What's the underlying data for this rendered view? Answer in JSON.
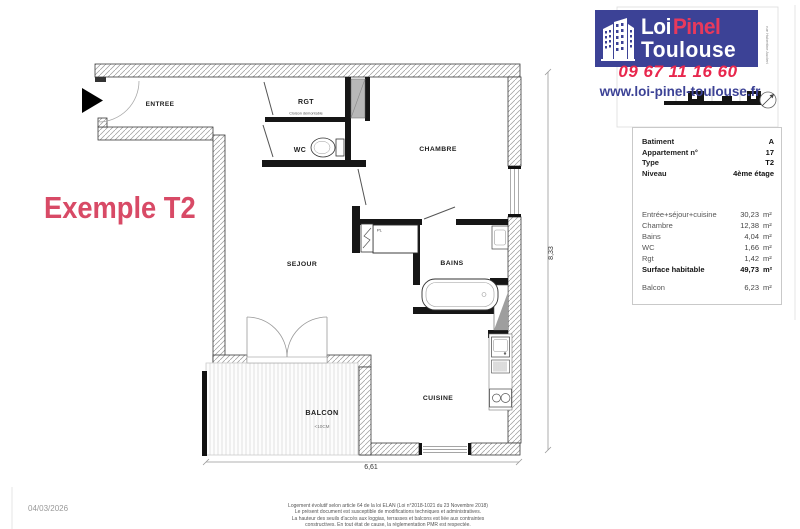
{
  "brand": {
    "logo_part1": "Loi",
    "logo_part2": "Pinel",
    "logo_line2": "Toulouse",
    "phone": "09 67 11 16 60",
    "website": "www.loi-pinel-toulouse.fr",
    "street_label": "rue Hubertine Auclert",
    "north_label": "N",
    "colors": {
      "brand_blue": "#3c4296",
      "brand_red": "#e8274d"
    }
  },
  "watermark": {
    "title": "Exemple T2",
    "color": "#d84a66"
  },
  "info_panel": {
    "fields": [
      {
        "label": "Batiment",
        "value": "A"
      },
      {
        "label": "Appartement n°",
        "value": "17"
      },
      {
        "label": "Type",
        "value": "T2"
      },
      {
        "label": "Niveau",
        "value": "4ème étage"
      }
    ],
    "areas": [
      {
        "label": "Entrée+séjour+cuisine",
        "value": "30,23",
        "unit": "m²"
      },
      {
        "label": "Chambre",
        "value": "12,38",
        "unit": "m²"
      },
      {
        "label": "Bains",
        "value": "4,04",
        "unit": "m²"
      },
      {
        "label": "WC",
        "value": "1,66",
        "unit": "m²"
      },
      {
        "label": "Rgt",
        "value": "1,42",
        "unit": "m²"
      },
      {
        "label": "Surface habitable",
        "value": "49,73",
        "unit": "m²"
      },
      {
        "label": "Balcon",
        "value": "6,23",
        "unit": "m²"
      }
    ]
  },
  "floor_plan": {
    "rooms": {
      "entree": "ENTREE",
      "rgt": "RGT",
      "wc": "WC",
      "chambre": "CHAMBRE",
      "sejour": "SEJOUR",
      "bains": "BAINS",
      "cuisine": "CUISINE",
      "balcon": "BALCON"
    },
    "annotations": {
      "cloison": "Cloison démontable",
      "pl": "PL",
      "balcon_note": "<10CM"
    },
    "dimensions": {
      "width": "6,61",
      "height": "8,33"
    }
  },
  "footer": {
    "date": "04/03/2026",
    "legal_lines": [
      "Logement évolutif selon article 64 de la loi ELAN (Loi n°2018-1021 du 23 Novembre 2018)",
      "Le présent document est susceptible de modifications techniques et administratives.",
      "La hauteur des seuils d'accès aux loggias, terrasses et balcons est liée aux contraintes",
      "constructives. En tout état de cause, la réglementation PMR est respectée."
    ]
  }
}
